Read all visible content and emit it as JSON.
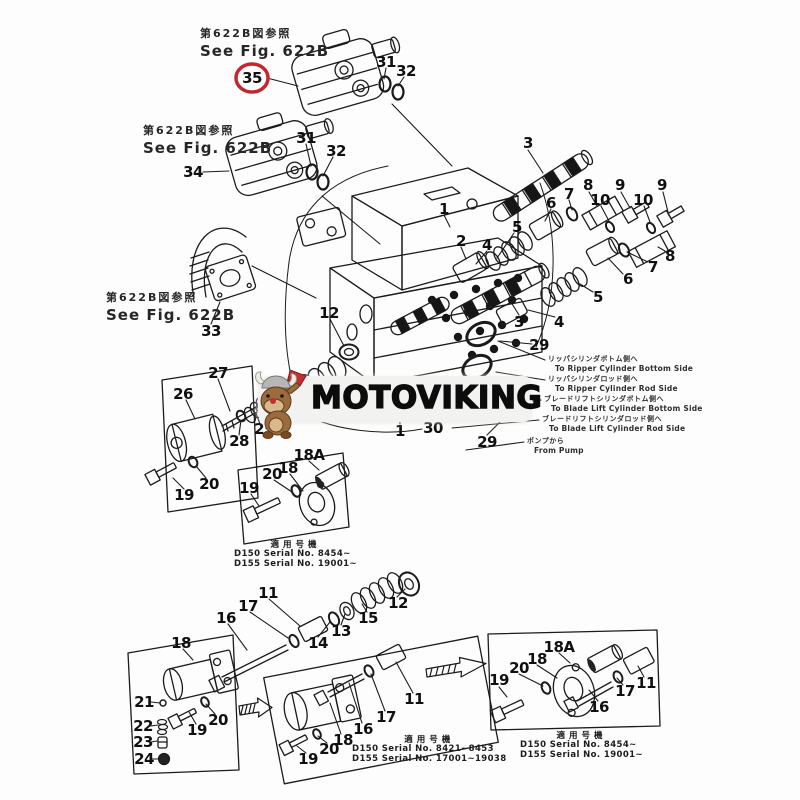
{
  "banner": {
    "brand": "MOTOVIKING",
    "logo": "viking-mascot-icon",
    "bg_color": "#f2f2f0",
    "text_color": "#0c0c0c"
  },
  "highlight": {
    "part": "35",
    "color": "#c4262e"
  },
  "fig_refs": [
    {
      "jp": "第622B図参照",
      "en": "See Fig. 622B",
      "x": 200,
      "y": 25
    },
    {
      "jp": "第622B図参照",
      "en": "See Fig. 622B",
      "x": 143,
      "y": 122
    },
    {
      "jp": "第622B図参照",
      "en": "See Fig. 622B",
      "x": 106,
      "y": 289
    }
  ],
  "annotations": [
    {
      "jp": "リッパシリンダボトム側へ",
      "en": "To Ripper Cylinder Bottom Side",
      "x": 548,
      "y": 355
    },
    {
      "jp": "リッパシリンダロッド側へ",
      "en": "To Ripper Cylinder Rod Side",
      "x": 548,
      "y": 375
    },
    {
      "jp": "ブレードリフトシリンダボトム側へ",
      "en": "To Blade Lift Cylinder Bottom Side",
      "x": 544,
      "y": 395
    },
    {
      "jp": "ブレードリフトシリンダロッド側へ",
      "en": "To Blade Lift Cylinder Rod Side",
      "x": 542,
      "y": 415
    },
    {
      "jp": "ポンプから",
      "en": "From Pump",
      "x": 527,
      "y": 437
    }
  ],
  "serial_blocks": [
    {
      "header": "適用号機",
      "lines": [
        "D150  Serial  No.  8454~",
        "D155  Serial  No.  19001~"
      ],
      "x": 234,
      "y": 541
    },
    {
      "header": "適用号機",
      "lines": [
        "D150  Serial  No.  8421~8453",
        "D155  Serial  No.  17001~19038"
      ],
      "x": 352,
      "y": 736
    },
    {
      "header": "適用号機",
      "lines": [
        "D150  Serial  No.  8454~",
        "D155  Serial  No.  19001~"
      ],
      "x": 520,
      "y": 732
    }
  ],
  "part_labels": [
    {
      "t": "35",
      "x": 252,
      "y": 78
    },
    {
      "t": "31",
      "x": 386,
      "y": 62
    },
    {
      "t": "32",
      "x": 406,
      "y": 71
    },
    {
      "t": "34",
      "x": 193,
      "y": 172
    },
    {
      "t": "31",
      "x": 306,
      "y": 138
    },
    {
      "t": "32",
      "x": 336,
      "y": 151
    },
    {
      "t": "33",
      "x": 211,
      "y": 331
    },
    {
      "t": "3",
      "x": 528,
      "y": 143
    },
    {
      "t": "5",
      "x": 517,
      "y": 227
    },
    {
      "t": "4",
      "x": 487,
      "y": 245
    },
    {
      "t": "6",
      "x": 551,
      "y": 203
    },
    {
      "t": "7",
      "x": 569,
      "y": 194
    },
    {
      "t": "8",
      "x": 588,
      "y": 185
    },
    {
      "t": "10",
      "x": 600,
      "y": 200
    },
    {
      "t": "9",
      "x": 620,
      "y": 185
    },
    {
      "t": "10",
      "x": 643,
      "y": 200
    },
    {
      "t": "9",
      "x": 662,
      "y": 185
    },
    {
      "t": "8",
      "x": 670,
      "y": 256
    },
    {
      "t": "7",
      "x": 653,
      "y": 267
    },
    {
      "t": "6",
      "x": 628,
      "y": 279
    },
    {
      "t": "5",
      "x": 598,
      "y": 297
    },
    {
      "t": "4",
      "x": 559,
      "y": 322
    },
    {
      "t": "3",
      "x": 519,
      "y": 322
    },
    {
      "t": "1",
      "x": 444,
      "y": 209
    },
    {
      "t": "2",
      "x": 461,
      "y": 241
    },
    {
      "t": "12",
      "x": 329,
      "y": 313
    },
    {
      "t": "29",
      "x": 539,
      "y": 345
    },
    {
      "t": "1",
      "x": 400,
      "y": 431
    },
    {
      "t": "30",
      "x": 433,
      "y": 428
    },
    {
      "t": "29",
      "x": 487,
      "y": 442
    },
    {
      "t": "27",
      "x": 218,
      "y": 373
    },
    {
      "t": "26",
      "x": 183,
      "y": 394
    },
    {
      "t": "25",
      "x": 264,
      "y": 429
    },
    {
      "t": "28",
      "x": 239,
      "y": 441
    },
    {
      "t": "20",
      "x": 209,
      "y": 484
    },
    {
      "t": "19",
      "x": 184,
      "y": 495
    },
    {
      "t": "18A",
      "x": 309,
      "y": 455
    },
    {
      "t": "18",
      "x": 288,
      "y": 468
    },
    {
      "t": "20",
      "x": 272,
      "y": 474
    },
    {
      "t": "19",
      "x": 249,
      "y": 488
    },
    {
      "t": "11",
      "x": 268,
      "y": 593
    },
    {
      "t": "17",
      "x": 248,
      "y": 606
    },
    {
      "t": "16",
      "x": 226,
      "y": 618
    },
    {
      "t": "14",
      "x": 318,
      "y": 643
    },
    {
      "t": "13",
      "x": 341,
      "y": 631
    },
    {
      "t": "15",
      "x": 368,
      "y": 618
    },
    {
      "t": "12",
      "x": 398,
      "y": 603
    },
    {
      "t": "18",
      "x": 181,
      "y": 643
    },
    {
      "t": "21",
      "x": 144,
      "y": 702
    },
    {
      "t": "22",
      "x": 143,
      "y": 726
    },
    {
      "t": "23",
      "x": 143,
      "y": 742
    },
    {
      "t": "24",
      "x": 144,
      "y": 759
    },
    {
      "t": "19",
      "x": 197,
      "y": 730
    },
    {
      "t": "20",
      "x": 218,
      "y": 720
    },
    {
      "t": "11",
      "x": 414,
      "y": 699
    },
    {
      "t": "17",
      "x": 386,
      "y": 717
    },
    {
      "t": "16",
      "x": 363,
      "y": 729
    },
    {
      "t": "18",
      "x": 343,
      "y": 740
    },
    {
      "t": "20",
      "x": 329,
      "y": 749
    },
    {
      "t": "19",
      "x": 308,
      "y": 759
    },
    {
      "t": "18A",
      "x": 559,
      "y": 647
    },
    {
      "t": "18",
      "x": 537,
      "y": 659
    },
    {
      "t": "20",
      "x": 519,
      "y": 668
    },
    {
      "t": "19",
      "x": 499,
      "y": 680
    },
    {
      "t": "16",
      "x": 599,
      "y": 707
    },
    {
      "t": "17",
      "x": 625,
      "y": 691
    },
    {
      "t": "11",
      "x": 646,
      "y": 683
    }
  ]
}
